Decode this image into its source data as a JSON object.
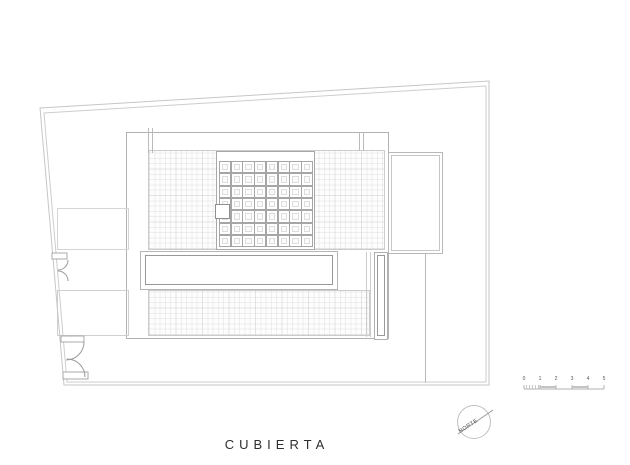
{
  "drawing_title": "CUBIERTA",
  "north_indicator": {
    "label": "NORTE"
  },
  "scale_bar": {
    "labels": [
      "0",
      "1",
      "2",
      "3",
      "4",
      "5"
    ]
  },
  "plan": {
    "coffer_grid": {
      "columns": 8,
      "rows": 7
    }
  },
  "colors": {
    "background": "#ffffff",
    "boundary_line": "#c6c6c6",
    "envelope_line": "#b2b2b2",
    "strong_line": "#989898",
    "light_line": "#cccccc",
    "hatch_line": "#e8e8e8",
    "title_text": "#2e2e2e",
    "small_text": "#555555"
  }
}
